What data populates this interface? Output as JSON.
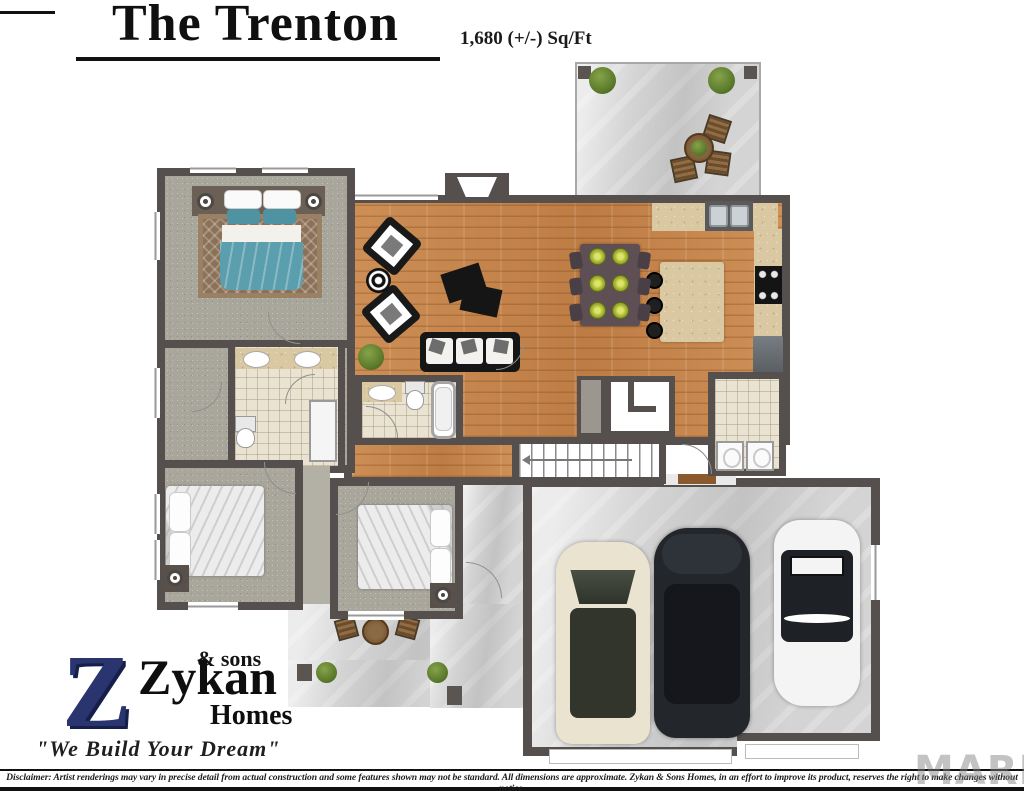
{
  "header": {
    "title": "The Trenton",
    "sqft_label": "1,680 (+/-) Sq/Ft"
  },
  "logo": {
    "monogram": "Z",
    "sub_top": "& sons",
    "name": "Zykan",
    "sub_bottom": "Homes",
    "tagline": "\"We Build Your Dream\""
  },
  "footer": {
    "disclaimer": "Disclaimer: Artist renderings may vary in precise detail from actual construction and some features shown may not be standard. All dimensions are approximate. Zykan & Sons Homes, in an effort to improve its product, reserves the right to make changes without notice."
  },
  "watermark": {
    "text": "MARIS"
  },
  "palette": {
    "wall": "#55504d",
    "wood_floor": "#c6874e",
    "carpet": "#a9a69b",
    "concrete": "#d4d4d4",
    "bath_tile": "#eae3d2",
    "counter_marble": "#d9c8a2",
    "bed_teal": "#5b9fae",
    "rug_brown": "#8a7157",
    "logo_navy": "#2a3570",
    "plant_green": "#5d7c2c",
    "van_cream": "#eae3d0",
    "sedan_black": "#23262b",
    "car_white": "#f4f4f4"
  }
}
